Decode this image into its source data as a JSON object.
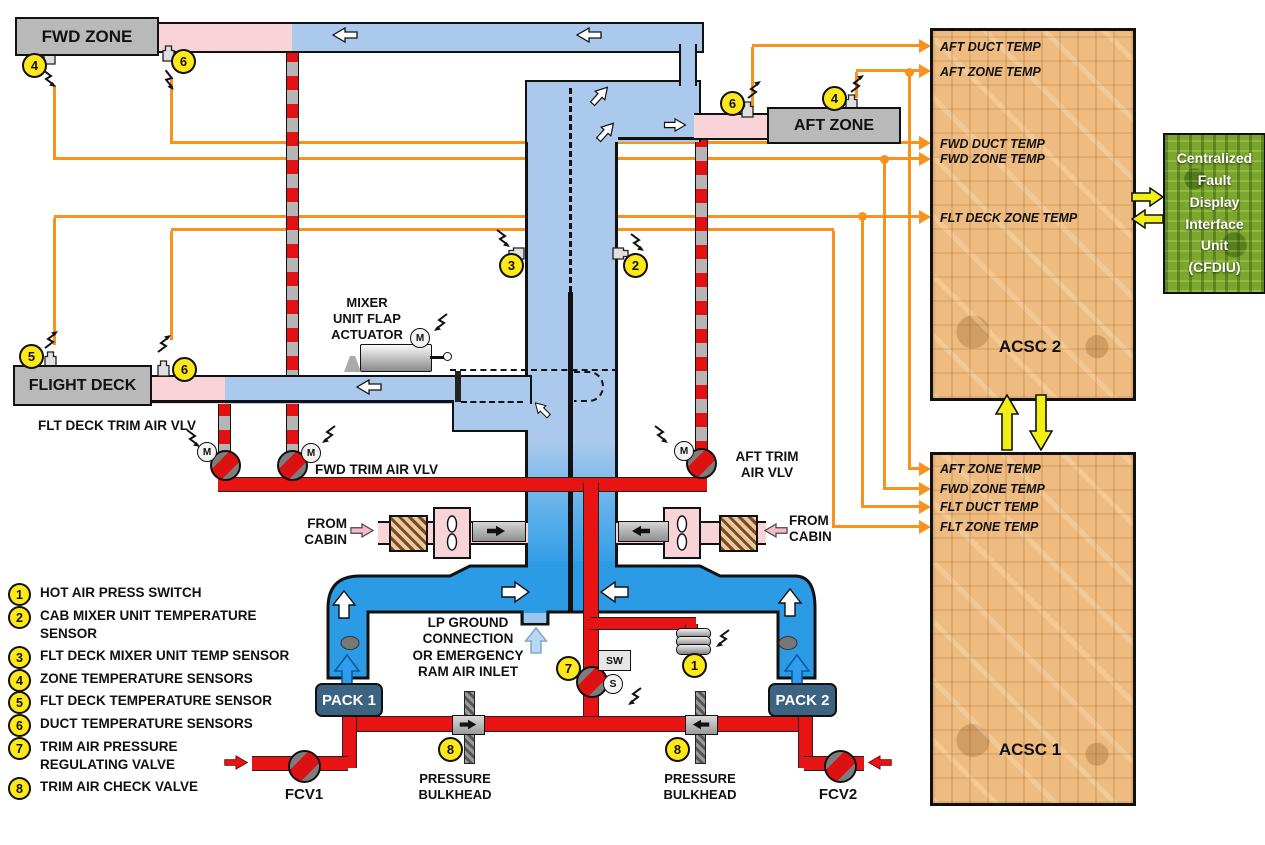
{
  "zones": {
    "fwd": "FWD ZONE",
    "aft": "AFT ZONE",
    "flight_deck": "FLIGHT DECK"
  },
  "packs": {
    "pack1": "PACK 1",
    "pack2": "PACK 2",
    "fcv1": "FCV1",
    "fcv2": "FCV2"
  },
  "ducting_labels": {
    "mixer_actuator": "MIXER\nUNIT FLAP\nACTUATOR",
    "flt_deck_trim_vlv": "FLT DECK TRIM AIR VLV",
    "fwd_trim_vlv": "FWD TRIM AIR VLV",
    "aft_trim_vlv": "AFT TRIM\nAIR VLV",
    "from_cabin_left": "FROM\nCABIN",
    "from_cabin_right": "FROM\nCABIN",
    "lp_ground": "LP GROUND\nCONNECTION\nOR EMERGENCY\nRAM AIR INLET",
    "pressure_bulkhead_left": "PRESSURE\nBULKHEAD",
    "pressure_bulkhead_right": "PRESSURE\nBULKHEAD"
  },
  "controllers": {
    "acsc2": {
      "title": "ACSC 2",
      "inputs": [
        "AFT DUCT TEMP",
        "AFT ZONE TEMP",
        "FWD DUCT TEMP",
        "FWD ZONE TEMP",
        "FLT DECK ZONE TEMP"
      ]
    },
    "acsc1": {
      "title": "ACSC 1",
      "inputs": [
        "AFT ZONE TEMP",
        "FWD ZONE TEMP",
        "FLT DUCT TEMP",
        "FLT ZONE TEMP"
      ]
    },
    "cfdiu": "Centralized\nFault\nDisplay\nInterface\nUnit\n(CFDIU)"
  },
  "markers": {
    "motor": "M",
    "switch_box": "SW",
    "switch": "S"
  },
  "badges": {
    "b1": "1",
    "b2": "2",
    "b3": "3",
    "b4": "4",
    "b5": "5",
    "b6": "6",
    "b7": "7",
    "b8": "8"
  },
  "legend": [
    {
      "num": "1",
      "text": "HOT AIR PRESS SWITCH"
    },
    {
      "num": "2",
      "text": "CAB MIXER UNIT TEMPERATURE\nSENSOR"
    },
    {
      "num": "3",
      "text": "FLT DECK MIXER UNIT TEMP SENSOR"
    },
    {
      "num": "4",
      "text": "ZONE TEMPERATURE SENSORS"
    },
    {
      "num": "5",
      "text": "FLT DECK TEMPERATURE SENSOR"
    },
    {
      "num": "6",
      "text": "DUCT TEMPERATURE SENSORS"
    },
    {
      "num": "7",
      "text": "TRIM AIR PRESSURE\nREGULATING VALVE"
    },
    {
      "num": "8",
      "text": "TRIM AIR CHECK VALVE"
    }
  ],
  "colors": {
    "duct_blue": "#aac9ec",
    "manifold_blue": "#2b9be6",
    "warm_pink": "#f8d3d8",
    "hot_red": "#e81414",
    "signal_orange": "#f7921e",
    "badge_yellow": "#ffe817",
    "data_yellow": "#f2ef15",
    "acsc_board": "#eebb80",
    "cfdiu_green": "#7ca62e"
  }
}
